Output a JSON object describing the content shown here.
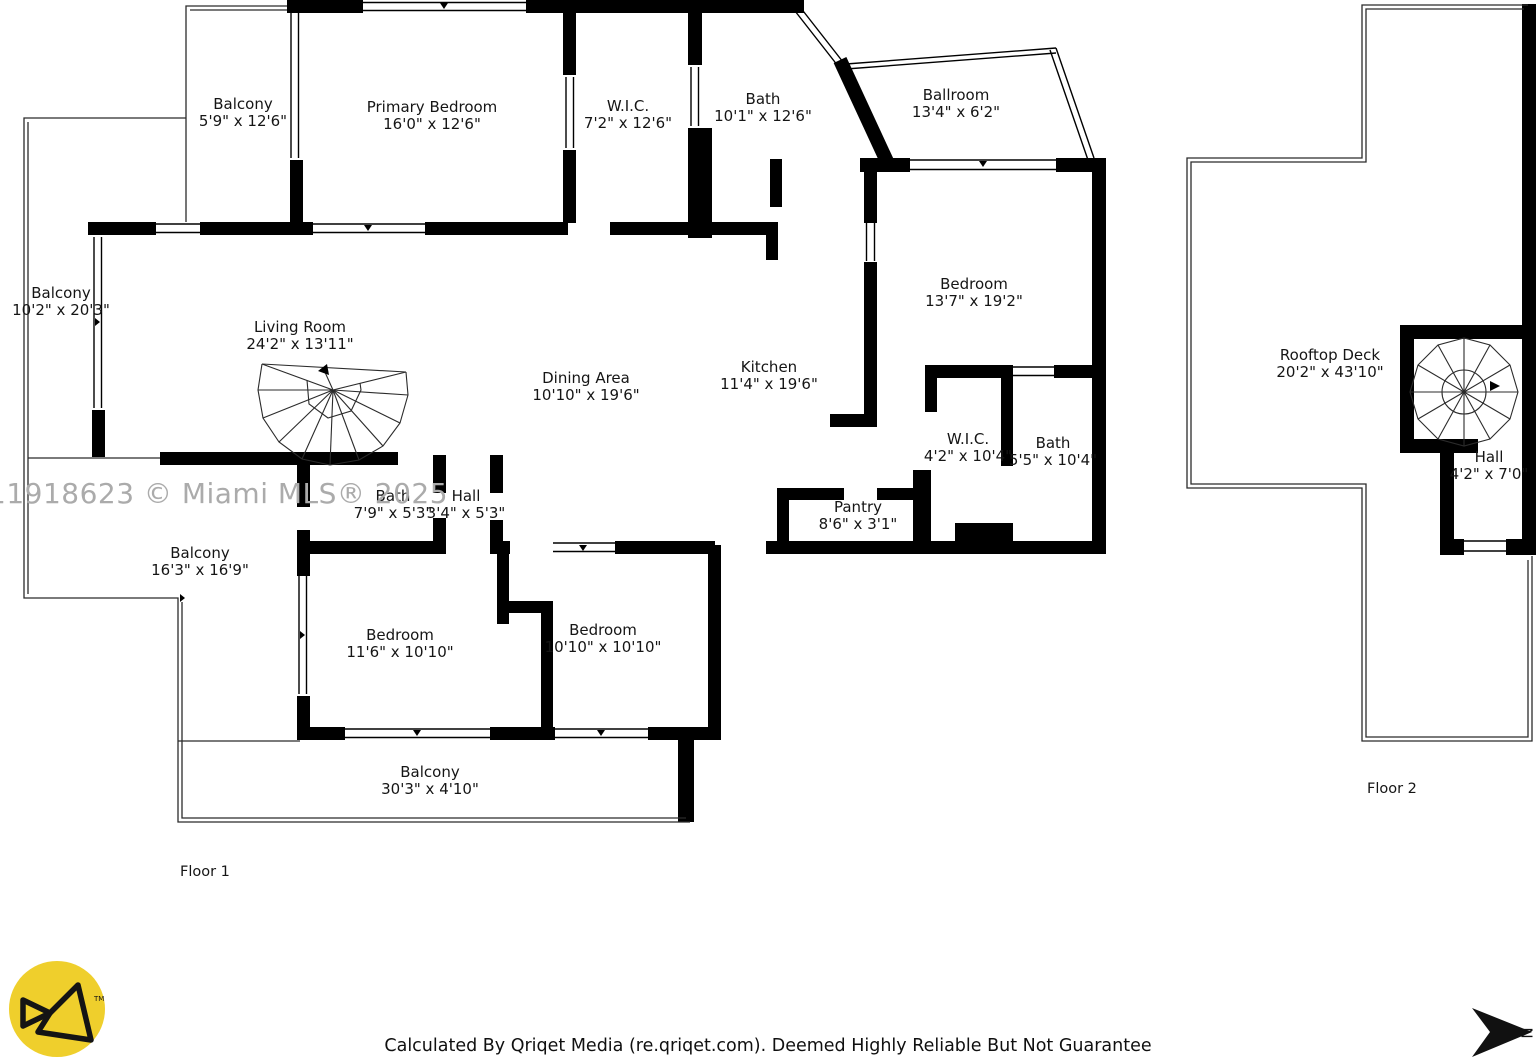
{
  "watermark": "11918623 © Miami MLS® 2025",
  "footer_text": "Calculated By Qriqet Media (re.qriqet.com). Deemed Highly Reliable But Not Guarantee",
  "compass_letter": "N",
  "logo_tm": "TM",
  "colors": {
    "wall_black": "#000000",
    "logo_yellow": "#efcf2c",
    "watermark_gray": "#ababab"
  },
  "floors": [
    {
      "label": "Floor 1",
      "rooms": [
        {
          "name": "Balcony",
          "dims": "5'9\" x 12'6\""
        },
        {
          "name": "Primary Bedroom",
          "dims": "16'0\" x 12'6\""
        },
        {
          "name": "W.I.C.",
          "dims": "7'2\" x 12'6\""
        },
        {
          "name": "Bath",
          "dims": "10'1\" x 12'6\""
        },
        {
          "name": "Ballroom",
          "dims": "13'4\" x 6'2\""
        },
        {
          "name": "Bedroom",
          "dims": "13'7\" x 19'2\""
        },
        {
          "name": "Balcony",
          "dims": "10'2\" x 20'3\""
        },
        {
          "name": "Living Room",
          "dims": "24'2\" x 13'11\""
        },
        {
          "name": "Dining Area",
          "dims": "10'10\" x 19'6\""
        },
        {
          "name": "Kitchen",
          "dims": "11'4\" x 19'6\""
        },
        {
          "name": "W.I.C.",
          "dims": "4'2\" x 10'4\""
        },
        {
          "name": "Bath",
          "dims": "5'5\" x 10'4\""
        },
        {
          "name": "Pantry",
          "dims": "8'6\" x 3'1\""
        },
        {
          "name": "Bath",
          "dims": "7'9\" x 5'3\""
        },
        {
          "name": "Hall",
          "dims": "3'4\" x 5'3\""
        },
        {
          "name": "Balcony",
          "dims": "16'3\" x 16'9\""
        },
        {
          "name": "Bedroom",
          "dims": "11'6\" x 10'10\""
        },
        {
          "name": "Bedroom",
          "dims": "10'10\" x 10'10\""
        },
        {
          "name": "Balcony",
          "dims": "30'3\" x 4'10\""
        }
      ]
    },
    {
      "label": "Floor 2",
      "rooms": [
        {
          "name": "Rooftop Deck",
          "dims": "20'2\" x 43'10\""
        },
        {
          "name": "Hall",
          "dims": "4'2\" x 7'0\""
        }
      ]
    }
  ]
}
